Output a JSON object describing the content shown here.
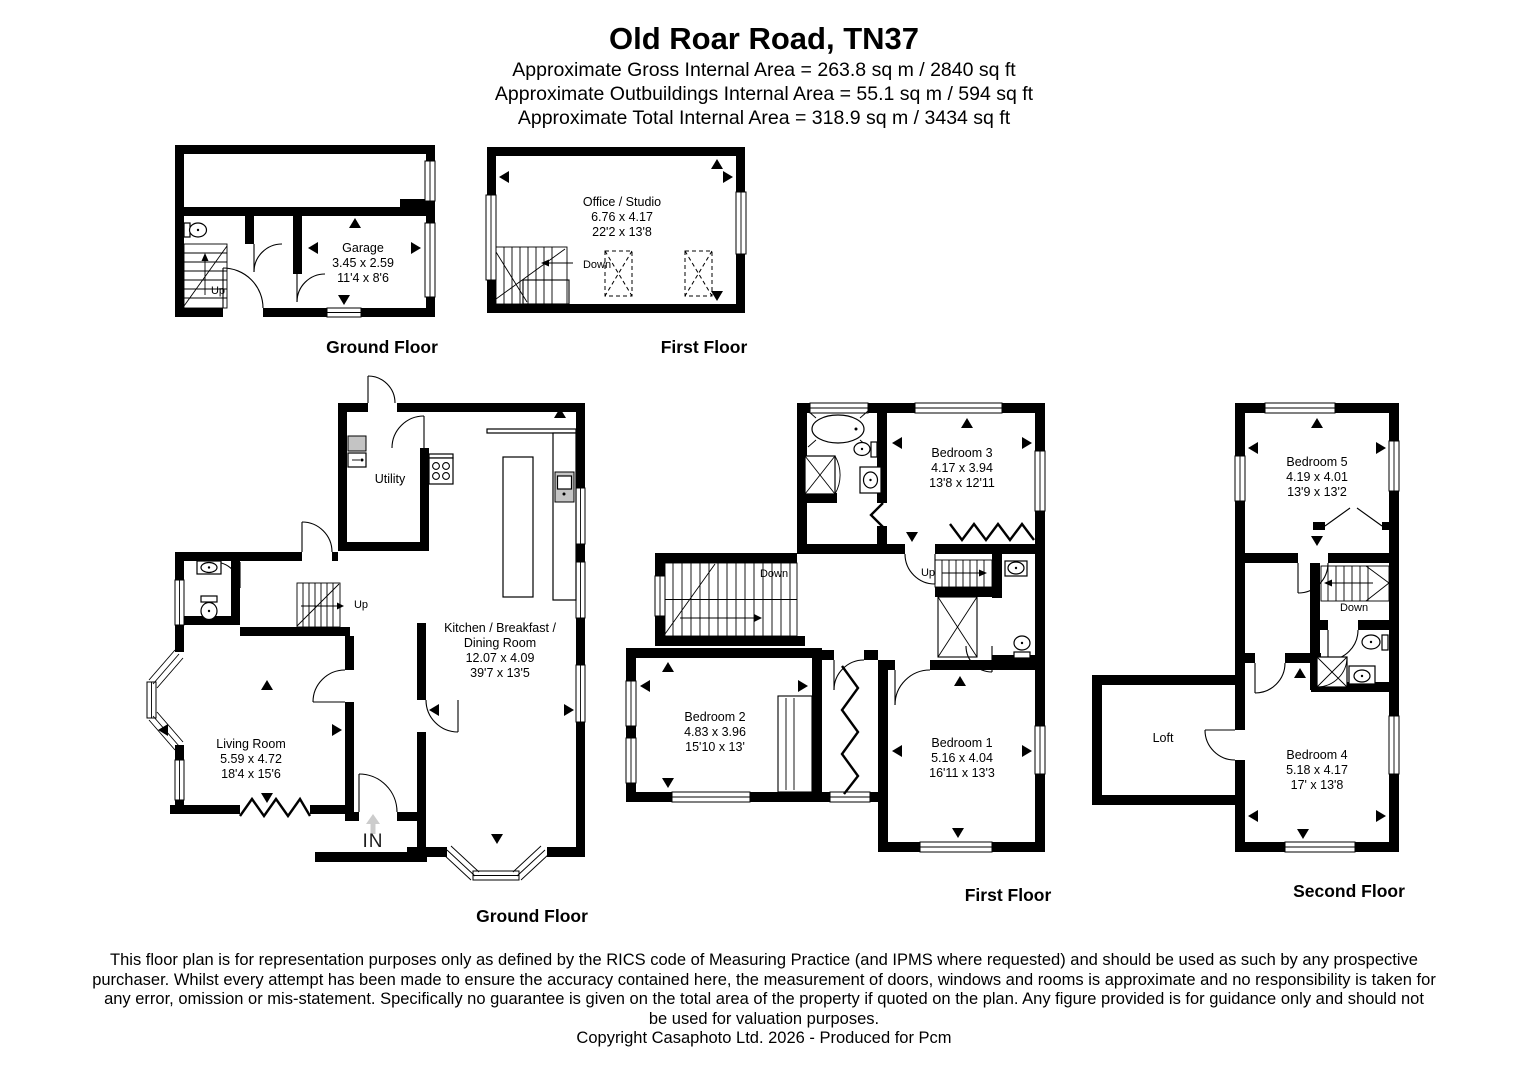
{
  "header": {
    "title": "Old Roar Road, TN37",
    "area_lines": [
      "Approximate Gross Internal Area = 263.8 sq m / 2840 sq ft",
      "Approximate Outbuildings Internal Area = 55.1 sq m / 594 sq ft",
      "Approximate Total Internal Area = 318.9 sq m / 3434 sq ft"
    ]
  },
  "plans": {
    "outbuilding_ground": {
      "floor_label": "Ground Floor",
      "room": {
        "name": "Garage",
        "metric": "3.45 x 2.59",
        "imperial": "11'4 x 8'6"
      },
      "up_label": "Up"
    },
    "outbuilding_first": {
      "floor_label": "First Floor",
      "room": {
        "name": "Office / Studio",
        "metric": "6.76 x 4.17",
        "imperial": "22'2 x 13'8"
      },
      "down_label": "Down"
    },
    "main_ground": {
      "floor_label": "Ground Floor",
      "utility": {
        "name": "Utility"
      },
      "kitchen": {
        "name_line1": "Kitchen / Breakfast /",
        "name_line2": "Dining Room",
        "metric": "12.07 x 4.09",
        "imperial": "39'7 x 13'5"
      },
      "living": {
        "name": "Living Room",
        "metric": "5.59 x 4.72",
        "imperial": "18'4 x 15'6"
      },
      "up_label": "Up",
      "in_label": "IN"
    },
    "main_first": {
      "floor_label": "First Floor",
      "bedroom3": {
        "name": "Bedroom 3",
        "metric": "4.17 x 3.94",
        "imperial": "13'8 x 12'11"
      },
      "bedroom2": {
        "name": "Bedroom 2",
        "metric": "4.83 x 3.96",
        "imperial": "15'10 x 13'"
      },
      "bedroom1": {
        "name": "Bedroom 1",
        "metric": "5.16 x 4.04",
        "imperial": "16'11 x 13'3"
      },
      "down_label": "Down",
      "up_label": "Up"
    },
    "main_second": {
      "floor_label": "Second Floor",
      "bedroom5": {
        "name": "Bedroom 5",
        "metric": "4.19 x 4.01",
        "imperial": "13'9 x 13'2"
      },
      "loft": {
        "name": "Loft"
      },
      "bedroom4": {
        "name": "Bedroom 4",
        "metric": "5.18 x 4.17",
        "imperial": "17' x 13'8"
      },
      "down_label": "Down"
    }
  },
  "footer": {
    "disclaimer_lines": [
      "This floor plan is for representation purposes only as defined by the RICS code of Measuring Practice (and IPMS where requested) and should be used as such by any prospective",
      "purchaser. Whilst every attempt has been made to ensure the accuracy contained here, the measurement of doors, windows and rooms is approximate and no responsibility is taken for",
      "any error, omission or mis-statement. Specifically no guarantee is given on the total area of the property if quoted on the plan. Any figure provided is for guidance only and should not",
      "be used for valuation purposes."
    ],
    "copyright": "Copyright Casaphoto Ltd. 2026 - Produced for Pcm"
  },
  "colors": {
    "wall": "#000000",
    "fixture": "#c4c4c4",
    "arrow_gray": "#cccccc"
  }
}
